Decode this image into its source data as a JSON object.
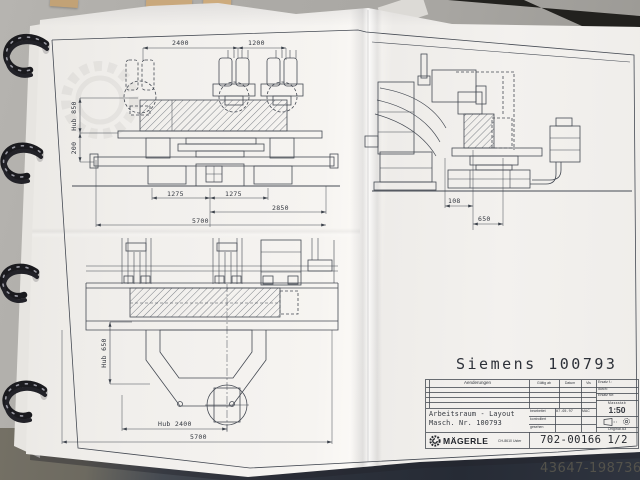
{
  "colors": {
    "ink": "#3f444d",
    "paper": "#f3f1ee",
    "floor": "#a9a7a3",
    "denim": "#2e333d"
  },
  "background": {
    "watermark_id": "43647-19873695"
  },
  "sheet": {
    "title": "Siemens 100793",
    "views": {
      "front": {
        "dim_top_left": "2400",
        "dim_top_right": "1200",
        "dim_hub850": "Hub 850",
        "dim_200": "200",
        "dim_b1": "1275",
        "dim_b2": "1275",
        "dim_b3": "2850",
        "dim_b4": "5700"
      },
      "plan": {
        "dim_hub650": "Hub 650",
        "dim_hub2400": "Hub 2400",
        "dim_5700": "5700"
      },
      "side": {
        "dim_108": "108",
        "dim_650": "650"
      }
    },
    "title_block": {
      "changes_header": "Aenderungen",
      "valid_from": "Gültig ab",
      "date": "Datum",
      "visa": "Vis",
      "replaced_1": "Ersatz f.:",
      "replaced_2": "durch:",
      "replaced_3": "Ersatz für:",
      "scale_label": "Massstab",
      "scale_value": "1:50",
      "doc_title": "Arbeitsraum - Layout",
      "doc_subtitle": "Masch. Nr. 100793",
      "row_edited_label": "bearbeitet",
      "row_edited_date": "07.05.97",
      "row_edited_visa": "MAC",
      "row_checked_label": "kontrolliert",
      "row_seen_label": "gesehen",
      "original_note": "Original A3",
      "company_name": "MÄGERLE",
      "company_location": "CH-8610 Uster",
      "drawing_number": "702-00166",
      "sheet_number": "1/2"
    }
  }
}
